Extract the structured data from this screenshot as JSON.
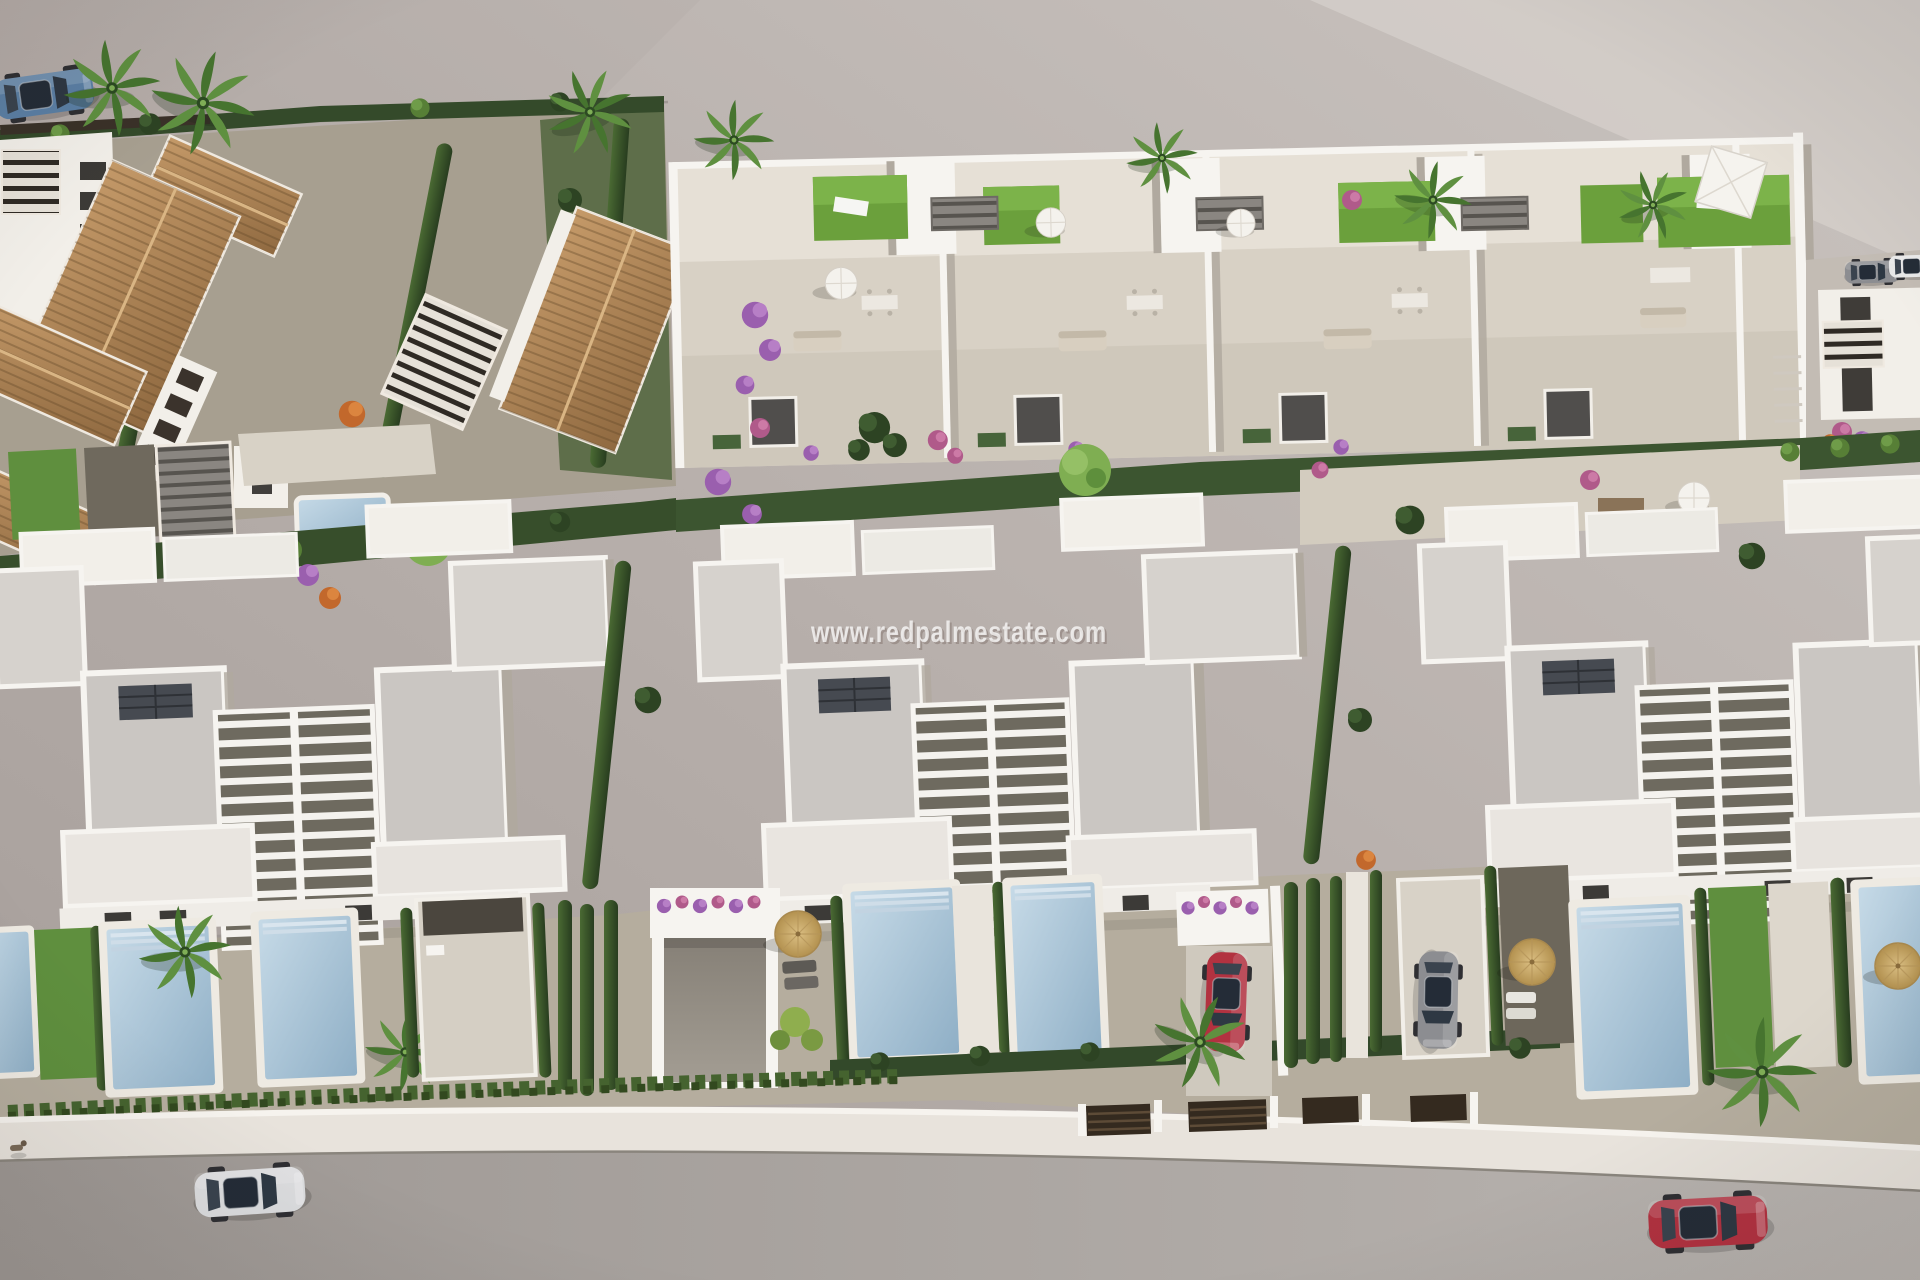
{
  "watermark": {
    "text": "www.redpalmestate.com"
  },
  "scene_label": "aerial 3D render of a residential development",
  "colors": {
    "ground_plane": "#b8b0ac",
    "ground_light": "#d4cec9",
    "white_wall": "#f2efe9",
    "flat_roof": "#cac6c2",
    "terracotta_roof": "#b98e5f",
    "stone_terrace": "#ddd7cd",
    "lawn_green": "#6ba03c",
    "hedge_green": "#36502b",
    "pool_water": "#aac6da",
    "road": "#aba5a1",
    "car_red": "#b23240",
    "car_blue": "#5b7fa4",
    "car_silver": "#dcdddf",
    "car_gray": "#8c8d91",
    "straw_umbrella": "#c9a96b"
  }
}
